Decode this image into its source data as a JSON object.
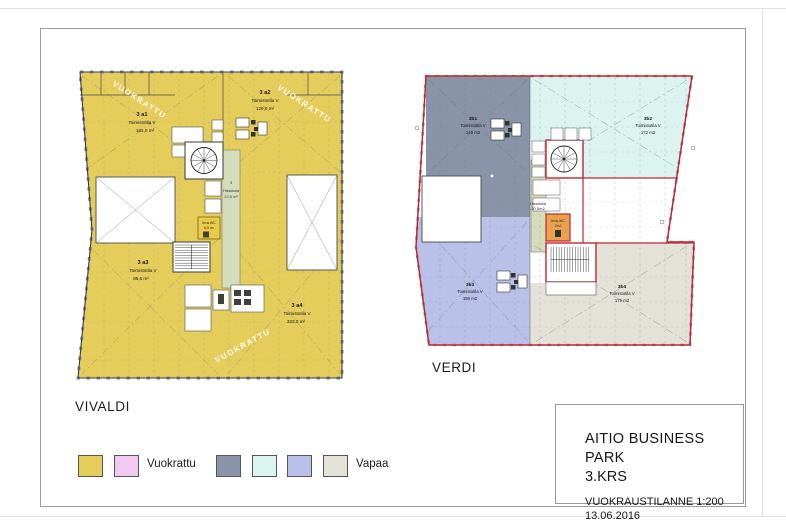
{
  "vivaldi": {
    "label": "VIVALDI",
    "watermark": "VUOKRATTU",
    "rooms": [
      {
        "id": "3 a1",
        "type": "Toimistotila V",
        "area": "181,0 m²"
      },
      {
        "id": "3 a2",
        "type": "Toimistotila V",
        "area": "129,0 m²"
      },
      {
        "id": "3 a3",
        "type": "Toimistotila V",
        "area": "85,5 m²"
      },
      {
        "id": "3 a4",
        "type": "Toimistotila V",
        "area": "323,0 m²"
      }
    ],
    "core": {
      "floor": "3",
      "lobby": "Hissiaula",
      "lobby_area": "22,0 m²",
      "wc": "Inva-WC",
      "wc_area": "6,0 m²"
    }
  },
  "verdi": {
    "label": "VERDI",
    "rooms": [
      {
        "id": "3b1",
        "type": "Toimistotila V",
        "area": "145 m2"
      },
      {
        "id": "3b2",
        "type": "Toimistotila V",
        "area": "172 m2"
      },
      {
        "id": "3b3",
        "type": "Toimistotila V",
        "area": "150 m2"
      },
      {
        "id": "3b4",
        "type": "Toimistotila V",
        "area": "179 m2"
      }
    ],
    "core": {
      "lobby": "Hissiaula",
      "lobby_area": "20,5m2",
      "wc": "Inva-WC",
      "wc_area": "7m2"
    }
  },
  "legend": {
    "vuokrattu": "Vuokrattu",
    "vapaa": "Vapaa"
  },
  "title_block": {
    "project": "AITIO BUSINESS PARK",
    "floor": "3.KRS",
    "status": "VUOKRAUSTILANNE 1:200",
    "date": "13.06.2016"
  },
  "colors": {
    "yellow": "#E5CD5C",
    "pink": "#F2C9F0",
    "gray": "#8A94A8",
    "cyan": "#DCF4F0",
    "periwinkle": "#B9C1E9",
    "beige": "#E4E2D8",
    "green": "#D5DCBC",
    "orange": "#E8A14E",
    "red": "#C0272D"
  }
}
